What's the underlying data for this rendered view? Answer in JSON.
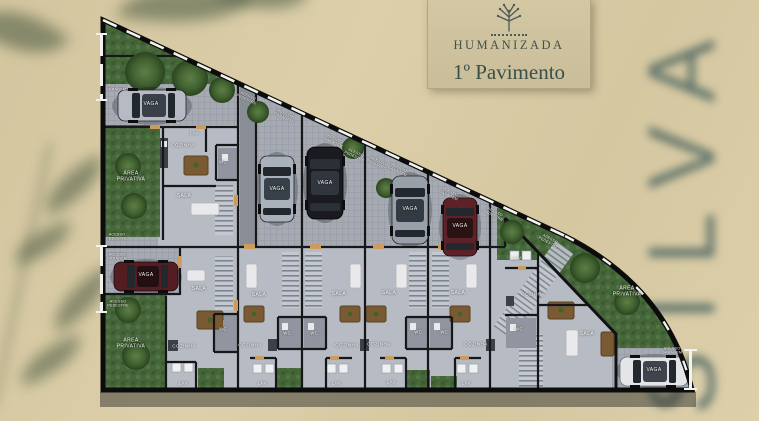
{
  "header": {
    "brand": "HUMANIZADA",
    "title": "1º Pavimento"
  },
  "watermark": {
    "text": "SILVA"
  },
  "plan": {
    "room_labels": {
      "vaga": "VAGA",
      "sala": "SALA",
      "cozinha": "COZINHA",
      "wc": "WC.",
      "wc_plain": "WC",
      "lav": "LAV.",
      "lav_plain": "LAV",
      "area_privativa": "ÁREA PRIVATIVA"
    },
    "access_labels": {
      "pedestre": "ACESSO PEDESTRE",
      "garagem": "ACESSO GARAGEM"
    }
  }
}
